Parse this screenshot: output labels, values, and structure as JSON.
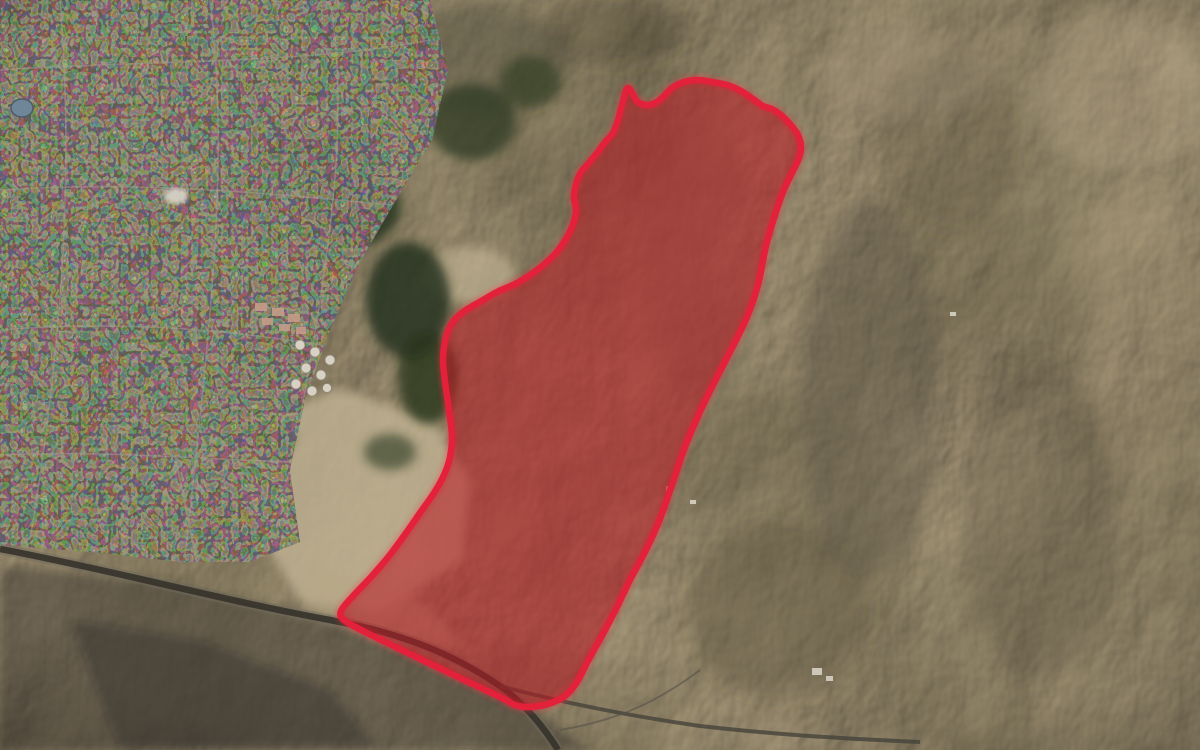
{
  "map": {
    "type": "satellite-imagery",
    "description": "Satellite aerial view of arid mountainous terrain beside an urban area, with a large operational zone highlighted in red",
    "highlighted_zone": {
      "label": "highlighted-zone",
      "border_color": "#e3213a",
      "glow_color": "#ff3347",
      "fill_color": "rgba(186,24,34,0.55)",
      "points": [
        [
          628,
          88
        ],
        [
          637,
          101
        ],
        [
          646,
          105
        ],
        [
          655,
          103
        ],
        [
          663,
          97
        ],
        [
          672,
          88
        ],
        [
          684,
          82
        ],
        [
          698,
          80
        ],
        [
          712,
          82
        ],
        [
          727,
          85
        ],
        [
          741,
          91
        ],
        [
          753,
          99
        ],
        [
          763,
          106
        ],
        [
          772,
          109
        ],
        [
          781,
          115
        ],
        [
          790,
          124
        ],
        [
          798,
          135
        ],
        [
          801,
          146
        ],
        [
          799,
          158
        ],
        [
          792,
          173
        ],
        [
          783,
          192
        ],
        [
          774,
          218
        ],
        [
          766,
          246
        ],
        [
          758,
          285
        ],
        [
          747,
          317
        ],
        [
          731,
          350
        ],
        [
          714,
          383
        ],
        [
          699,
          414
        ],
        [
          685,
          447
        ],
        [
          673,
          482
        ],
        [
          660,
          519
        ],
        [
          646,
          550
        ],
        [
          631,
          578
        ],
        [
          618,
          605
        ],
        [
          604,
          632
        ],
        [
          589,
          659
        ],
        [
          577,
          682
        ],
        [
          565,
          696
        ],
        [
          548,
          704
        ],
        [
          530,
          707
        ],
        [
          515,
          705
        ],
        [
          500,
          697
        ],
        [
          460,
          678
        ],
        [
          412,
          655
        ],
        [
          365,
          632
        ],
        [
          344,
          620
        ],
        [
          341,
          611
        ],
        [
          353,
          596
        ],
        [
          371,
          577
        ],
        [
          389,
          556
        ],
        [
          406,
          533
        ],
        [
          422,
          510
        ],
        [
          434,
          493
        ],
        [
          444,
          475
        ],
        [
          450,
          457
        ],
        [
          452,
          436
        ],
        [
          449,
          410
        ],
        [
          445,
          382
        ],
        [
          443,
          358
        ],
        [
          446,
          337
        ],
        [
          452,
          323
        ],
        [
          463,
          312
        ],
        [
          478,
          303
        ],
        [
          497,
          292
        ],
        [
          517,
          283
        ],
        [
          537,
          270
        ],
        [
          555,
          254
        ],
        [
          567,
          237
        ],
        [
          574,
          221
        ],
        [
          576,
          210
        ],
        [
          574,
          197
        ],
        [
          576,
          184
        ],
        [
          581,
          172
        ],
        [
          588,
          164
        ],
        [
          597,
          153
        ],
        [
          606,
          141
        ],
        [
          613,
          133
        ],
        [
          618,
          120
        ],
        [
          622,
          105
        ]
      ]
    },
    "features": [
      {
        "name": "urban-area",
        "location": "west"
      },
      {
        "name": "oil-tank-farm",
        "location": "center-west"
      },
      {
        "name": "orchard-groves",
        "location": "center"
      },
      {
        "name": "sand-flats",
        "location": "southwest-center"
      },
      {
        "name": "highway",
        "location": "southwest"
      },
      {
        "name": "mountain-ridges",
        "location": "east"
      },
      {
        "name": "pond",
        "location": "far-west"
      }
    ]
  }
}
